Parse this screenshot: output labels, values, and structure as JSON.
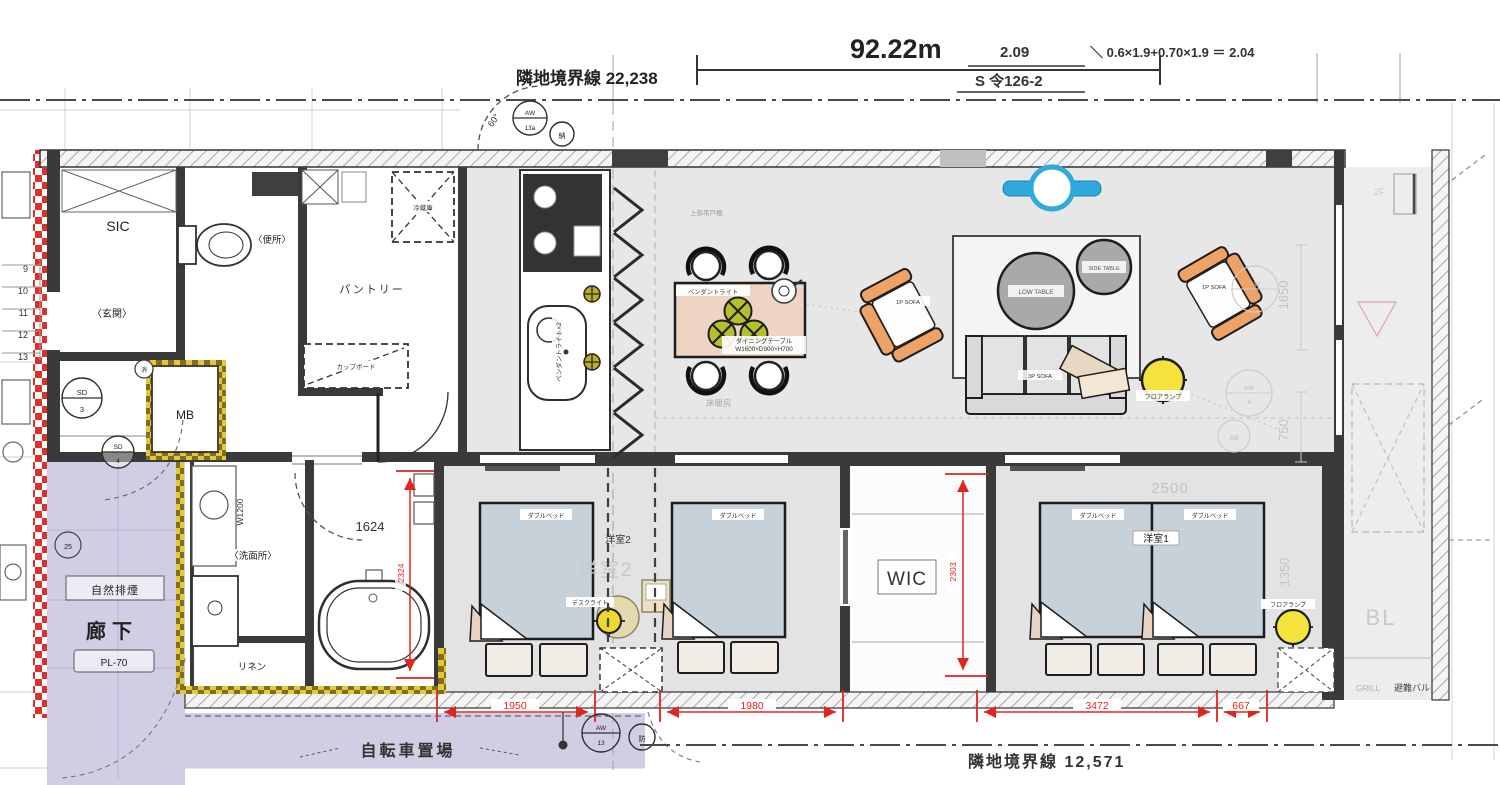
{
  "site": {
    "boundary_top": "隣地境界線 22,238",
    "span_top": "92.22m",
    "calc_value": "2.09",
    "calc_formula": "＼ 0.6×1.9+0.70×1.9 ＝ 2.04",
    "calc_ref": "S 令126-2",
    "boundary_bottom": "隣地境界線 12,571",
    "bicycle": "自転車置場"
  },
  "rooms": {
    "sic": "SIC",
    "toilet": "〈便所〉",
    "entrance": "〈玄関〉",
    "mb": "MB",
    "pantry": "パントリー",
    "cupboard": "カップボード",
    "fridge": "冷蔵庫",
    "corridor": "廊下",
    "smoke": "自然排煙",
    "pl": "PL-70",
    "washroom": "〈洗面所〉",
    "washer": "W1200",
    "linen": "リネン",
    "bath": "1624",
    "wic": "WIC",
    "bed1": "洋室1",
    "bed2": "洋室2",
    "bed2ghost": "洋室2",
    "balcony": "BL",
    "balcony2f": "2F",
    "grill": "GRILL",
    "evac": "避難バル",
    "floorheat": "床暖房",
    "upper_cab": "上部吊戸棚"
  },
  "furniture": {
    "bed": "ダブルベッド",
    "desk_light": "デスクライト",
    "floor_lamp": "フロアランプ",
    "pendant": "ペンダントライト",
    "pendant2": "ペンダントライト×2",
    "dining1": "ダイニングテーブル",
    "dining2": "W1600×D900×H700",
    "sofa1p": "1P SOFA",
    "sofa3p": "3P SOFA",
    "low_table": "LOW TABLE",
    "side_table": "SIDE TABLE"
  },
  "dims": {
    "w1": "1950",
    "w2": "1980",
    "w3": "3472",
    "w4": "667",
    "h_bath": "2324",
    "h_wic": "2303",
    "g2500": "2500",
    "g1350": "1350",
    "g1650": "1650",
    "g750": "750",
    "deg": "60°"
  },
  "markers": {
    "sd": "SD",
    "n3": "3",
    "n4": "4",
    "aw": "AW",
    "a13": "13a",
    "nou": "納",
    "n13": "13",
    "bou": "防",
    "shou": "消",
    "m25": "25",
    "a4": "4",
    "a1": "1",
    "ab": "AB"
  },
  "stairs": [
    "9",
    "10",
    "11",
    "12",
    "13"
  ]
}
